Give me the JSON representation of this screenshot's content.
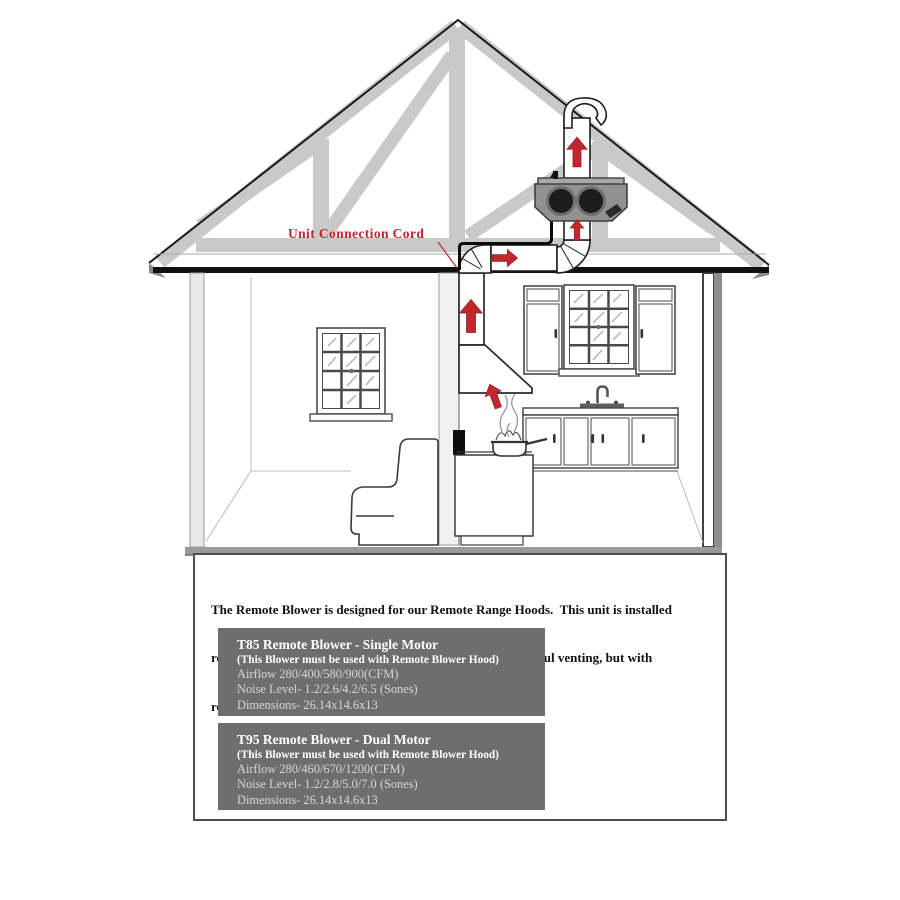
{
  "colors": {
    "arrow_red": "#c2272d",
    "label_red": "#c1252b",
    "truss_gray": "#c9c9c9",
    "unit_gray": "#919191",
    "panel_gray": "#6e6e6e",
    "floor_gray": "#9a9a9a"
  },
  "diagram": {
    "cord_label": "Unit Connection Cord",
    "icons": [
      "airflow-up-arrow-icon",
      "airflow-right-arrow-icon"
    ]
  },
  "description": {
    "lines": [
      "The Remote Blower is designed for our Remote Range Hoods.  This unit is installed",
      "remotely in the interior of your home.  This provides powerful venting, but with",
      "reduced noise."
    ]
  },
  "products": [
    {
      "title": "T85 Remote Blower - Single Motor",
      "subtitle": "(This Blower must be used with Remote Blower Hood)",
      "airflow": "Airflow 280/400/580/900(CFM)",
      "noise": "Noise Level- 1.2/2.6/4.2/6.5 (Sones)",
      "dimensions": "Dimensions- 26.14x14.6x13"
    },
    {
      "title": "T95 Remote Blower - Dual Motor",
      "subtitle": "(This Blower must be used with Remote Blower Hood)",
      "airflow": "Airflow 280/460/670/1200(CFM)",
      "noise": "Noise Level- 1.2/2.8/5.0/7.0 (Sones)",
      "dimensions": "Dimensions- 26.14x14.6x13"
    }
  ]
}
